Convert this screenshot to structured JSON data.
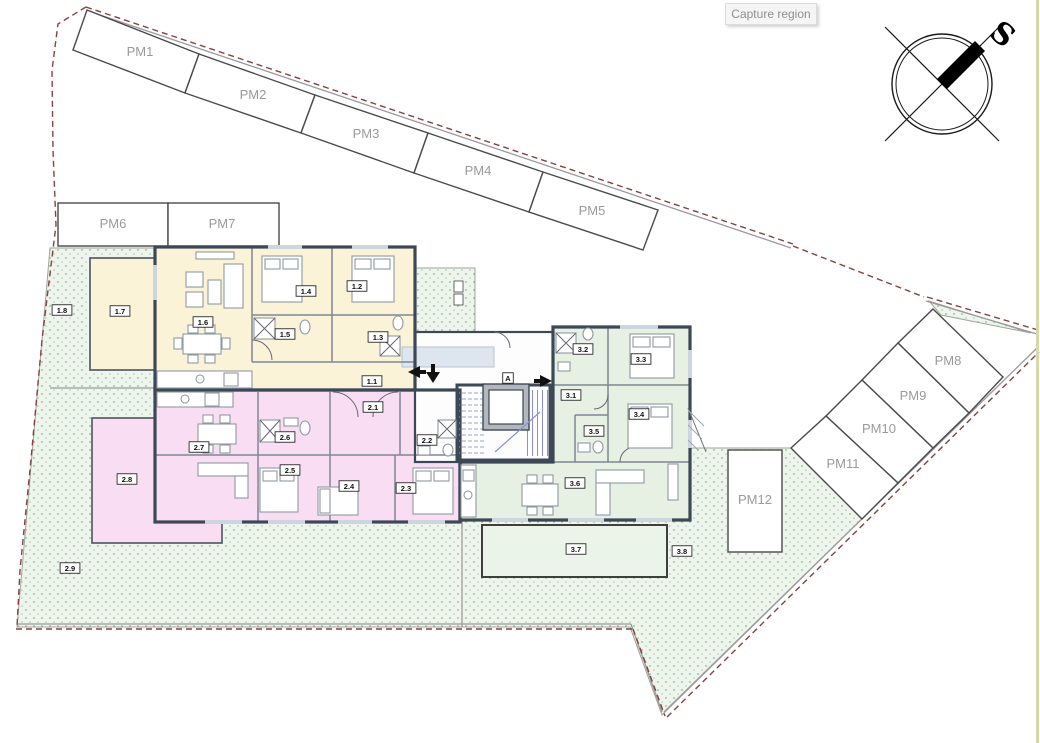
{
  "tooltip": {
    "label": "Capture region"
  },
  "compass": {
    "label": "S"
  },
  "parking": {
    "spaces": [
      "PM1",
      "PM2",
      "PM3",
      "PM4",
      "PM5",
      "PM6",
      "PM7",
      "PM8",
      "PM9",
      "PM10",
      "PM11",
      "PM12"
    ]
  },
  "stairwell": {
    "label": "A"
  },
  "units": {
    "unit1": {
      "name": "apartment-1-yellow",
      "rooms": [
        "1.1",
        "1.2",
        "1.3",
        "1.4",
        "1.5",
        "1.6",
        "1.7",
        "1.8"
      ]
    },
    "unit2": {
      "name": "apartment-2-pink",
      "rooms": [
        "2.1",
        "2.2",
        "2.3",
        "2.4",
        "2.5",
        "2.6",
        "2.7",
        "2.8",
        "2.9"
      ]
    },
    "unit3": {
      "name": "apartment-3-green",
      "rooms": [
        "3.1",
        "3.2",
        "3.3",
        "3.4",
        "3.5",
        "3.6",
        "3.7",
        "3.8"
      ]
    }
  },
  "colors": {
    "unit1_fill": "#faf3d8",
    "unit2_fill": "#f9ddf3",
    "unit3_fill": "#e7f1e3",
    "terrace3_fill": "#eaf4e8",
    "garden_bg": "#eef5ec",
    "garden_dot": "#8fb48f",
    "wall": "#3d4856",
    "interior_wall": "#7d8794",
    "boundary_red": "#8a4040",
    "parking_outline": "#4a4a4a",
    "parking_label": "#9a9a9a",
    "stairs_blue": "#8a90d8",
    "tooltip_bg": "#f5f5f5",
    "tooltip_text": "#8f8f8f"
  }
}
